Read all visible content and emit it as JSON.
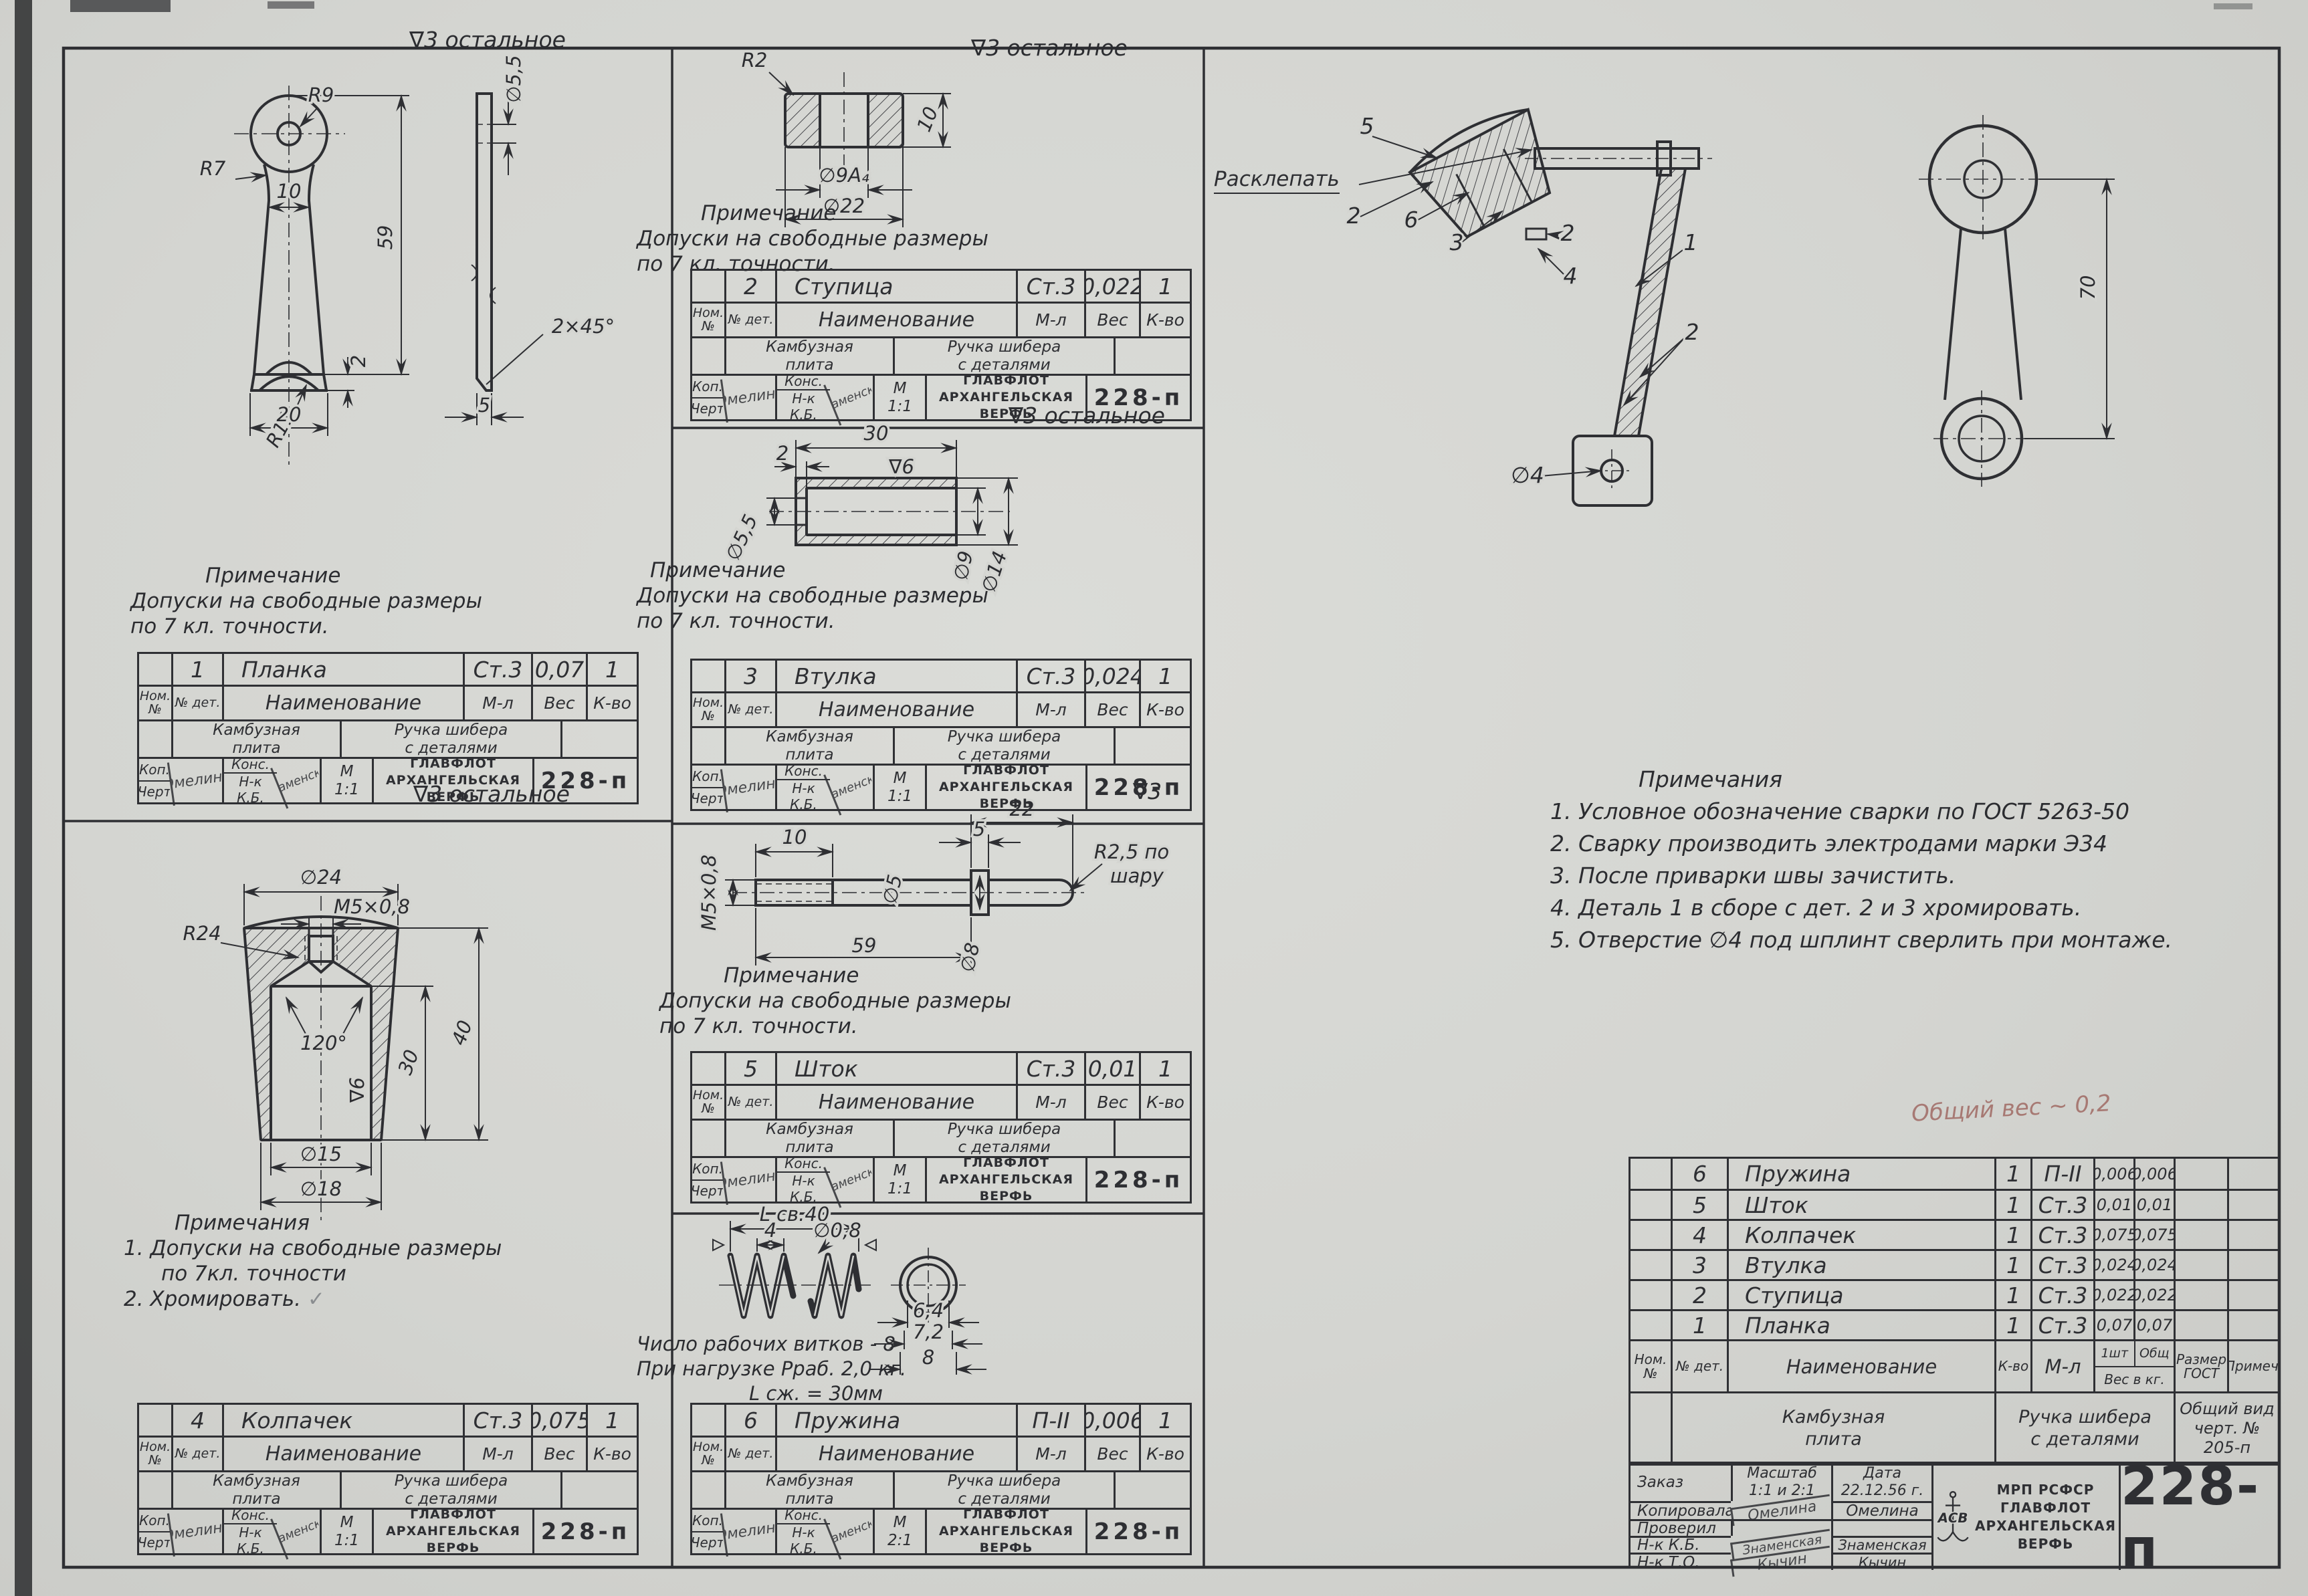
{
  "sheet": {
    "finish_full": "∇3 остальное",
    "finish_short": "∇3",
    "pencil": "Общий вес ~ 0,2"
  },
  "labels": {
    "nom_no": "Ном. №",
    "no_det": "№ дет.",
    "naimenovanie": "Наименование",
    "m_l": "М-л",
    "ves": "Вес",
    "k_vo": "К-во",
    "project_l1": "Камбузная",
    "project_l2": "плита",
    "assembly_l1": "Ручка шибера",
    "assembly_l2": "с деталями",
    "kop": "Коп.",
    "chert": "Черт",
    "kons": "Конс.",
    "nk_kb": "Н-к К.Б.",
    "scale_m": "М",
    "org1": "ГЛАВФЛОТ",
    "org2": "АРХАНГЕЛЬСКАЯ",
    "org3": "ВЕРФЬ",
    "code": "228-п"
  },
  "signatures": {
    "kop": "Омелина",
    "kb": "Знаменская"
  },
  "parts": [
    {
      "num": "1",
      "name": "Планка",
      "material": "Ст.3",
      "weight": "0,07",
      "qty": "1",
      "scale": "1:1"
    },
    {
      "num": "2",
      "name": "Ступица",
      "material": "Ст.3",
      "weight": "0,022",
      "qty": "1",
      "scale": "1:1"
    },
    {
      "num": "3",
      "name": "Втулка",
      "material": "Ст.3",
      "weight": "0,024",
      "qty": "1",
      "scale": "1:1"
    },
    {
      "num": "4",
      "name": "Колпачек",
      "material": "Ст.3",
      "weight": "0,075",
      "qty": "1",
      "scale": "1:1"
    },
    {
      "num": "5",
      "name": "Шток",
      "material": "Ст.3",
      "weight": "0,01",
      "qty": "1",
      "scale": "1:1"
    },
    {
      "num": "6",
      "name": "Пружина",
      "material": "П-II",
      "weight": "0,006",
      "qty": "1",
      "scale": "2:1"
    }
  ],
  "notes": {
    "single_title": "Примечание",
    "single_l1": "Допуски на свободные размеры",
    "single_l2": "по 7 кл. точности.",
    "kolp_title": "Примечания",
    "kolp_i1": "1. Допуски на свободные размеры",
    "kolp_i1b": "по 7кл. точности",
    "kolp_i2": "2. Хромировать.",
    "kolp_check": "✓",
    "spring_l1": "Число рабочих витков - 8",
    "spring_l2": "При нагрузке Рраб. 2,0 кг.",
    "spring_l3": "L сж. = 30мм",
    "asm_title": "Примечания",
    "asm_1": "1. Условное обозначение сварки по ГОСТ 5263-50",
    "asm_2": "2. Сварку производить электродами марки Э34",
    "asm_3": "3. После приварки швы зачистить.",
    "asm_4": "4. Деталь 1 в сборе с дет. 2 и 3 хромировать.",
    "asm_5": "5. Отверстие ∅4 под шплинт сверлить при монтаже."
  },
  "dims": {
    "planka": {
      "r9": "R9",
      "r7": "R7",
      "neck": "10",
      "len": "59",
      "t2": "2",
      "r11": "R11",
      "base": "20",
      "hole": "∅5,5",
      "cham": "2×45°",
      "thk": "5"
    },
    "stupitsa": {
      "r2": "R2",
      "bore": "∅9А₄",
      "od": "∅22",
      "h": "10"
    },
    "vtulka": {
      "len": "30",
      "step": "2",
      "d1": "∅5,5",
      "d2": "∅9",
      "d3": "∅14",
      "fin": "∇6"
    },
    "shtok": {
      "thread": "М5×0,8",
      "l1": "10",
      "d": "∅5",
      "len": "59",
      "w": "5",
      "l2": "22",
      "dc": "∅8",
      "ball1": "R2,5 по",
      "ball2": "шару"
    },
    "kolpachek": {
      "od": "∅24",
      "thread": "М5×0,8",
      "r24": "R24",
      "ang": "120°",
      "h1": "30",
      "h2": "40",
      "d1": "∅15",
      "d2": "∅18",
      "fin": "∇6"
    },
    "pruzhina": {
      "len": "L св.40",
      "pitch": "4",
      "wire": "∅0,8",
      "d1": "6,4",
      "d2": "7,2",
      "d3": "8"
    },
    "asm": {
      "c1": "1",
      "c2": "2",
      "c3": "3",
      "c4": "4",
      "c5": "5",
      "c6": "6",
      "raskl": "Расклепать",
      "d4": "∅4",
      "h": "70"
    }
  },
  "parts_list": {
    "headers": {
      "nom": "Ном. №",
      "det": "№ дет.",
      "name": "Наименование",
      "qty": "К-во",
      "mat": "М-л",
      "v1": "1шт",
      "v2": "Общ",
      "ves": "Вес в кг.",
      "razmer_l1": "Размер",
      "razmer_l2": "ГОСТ",
      "primech": "Примеч."
    },
    "rows": [
      {
        "det": "6",
        "name": "Пружина",
        "qty": "1",
        "mat": "П-II",
        "v1": "0,006",
        "v2": "0,006"
      },
      {
        "det": "5",
        "name": "Шток",
        "qty": "1",
        "mat": "Ст.3",
        "v1": "0,01",
        "v2": "0,01"
      },
      {
        "det": "4",
        "name": "Колпачек",
        "qty": "1",
        "mat": "Ст.3",
        "v1": "0,075",
        "v2": "0,075"
      },
      {
        "det": "3",
        "name": "Втулка",
        "qty": "1",
        "mat": "Ст.3",
        "v1": "0,024",
        "v2": "0,024"
      },
      {
        "det": "2",
        "name": "Ступица",
        "qty": "1",
        "mat": "Ст.3",
        "v1": "0,022",
        "v2": "0,022"
      },
      {
        "det": "1",
        "name": "Планка",
        "qty": "1",
        "mat": "Ст.3",
        "v1": "0,07",
        "v2": "0,07"
      }
    ]
  },
  "title_block": {
    "project_l1": "Камбузная",
    "project_l2": "плита",
    "assembly_l1": "Ручка шибера",
    "assembly_l2": "с деталями",
    "view_l1": "Общий вид",
    "view_l2": "черт. № 205-п",
    "zakaz": "Заказ",
    "masshtab_l": "Масштаб",
    "masshtab_v": "1:1 и 2:1",
    "data_l": "Дата",
    "data_v": "22.12.56 г.",
    "r1_l": "Копировала",
    "r1_s": "Омелина",
    "r1_n": "Омелина",
    "r2_l": "Проверил",
    "r3_l": "Н-к К.Б.",
    "r3_s": "Знаменская",
    "r3_n": "Знаменская",
    "r4_l": "Н-к Т.О.",
    "r4_s": "Кычин",
    "r4_n": "Кычин",
    "org0": "МРП РСФСР",
    "org1": "ГЛАВФЛОТ",
    "org2": "АРХАНГЕЛЬСКАЯ",
    "org3": "ВЕРФЬ",
    "logo": "АСВ",
    "number": "228-п"
  }
}
